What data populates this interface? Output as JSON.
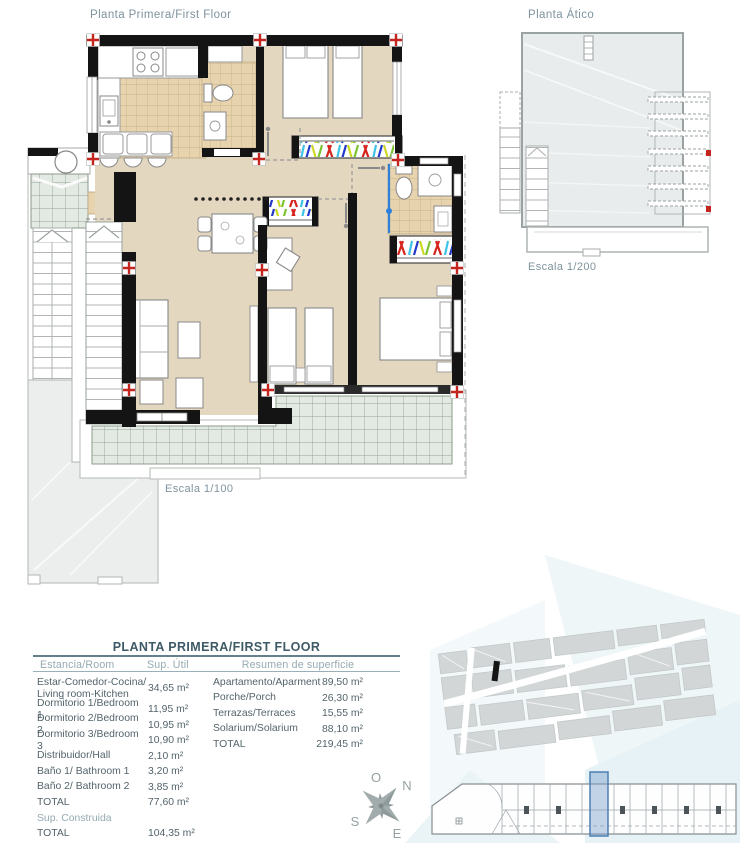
{
  "titles": {
    "first_floor": "Planta Primera/First Floor",
    "atico": "Planta Ático",
    "scale_main": "Escala 1/100",
    "scale_atico": "Escala 1/200"
  },
  "table": {
    "title": "PLANTA PRIMERA/FIRST FLOOR",
    "headers": {
      "room": "Estancia/Room",
      "area": "Sup. Útil",
      "summary": "Resumen de superficie"
    },
    "rooms": [
      {
        "label": "Estar-Comedor-Cocina/ Living room-Kitchen",
        "value": "34,65 m²"
      },
      {
        "label": "Dormitorio 1/Bedroom 1",
        "value": "11,95 m²"
      },
      {
        "label": "Dormitorio 2/Bedroom 2",
        "value": "10,95 m²"
      },
      {
        "label": "Dormitorio 3/Bedroom 3",
        "value": "10,90 m²"
      },
      {
        "label": "Distribuidor/Hall",
        "value": "2,10 m²"
      },
      {
        "label": "Baño 1/ Bathroom 1",
        "value": "3,20 m²"
      },
      {
        "label": "Baño 2/ Bathroom 2",
        "value": "3,85 m²"
      }
    ],
    "useful_total": {
      "label": "TOTAL",
      "value": "77,60 m²"
    },
    "built_header": "Sup. Construida",
    "built_total": {
      "label": "TOTAL",
      "value": "104,35 m²"
    },
    "summary_rows": [
      {
        "label": "Apartamento/Aparment",
        "value": "89,50 m²"
      },
      {
        "label": "Porche/Porch",
        "value": "26,30 m²"
      },
      {
        "label": "Terrazas/Terraces",
        "value": "15,55 m²"
      },
      {
        "label": "Solarium/Solarium",
        "value": "88,10 m²"
      },
      {
        "label": "TOTAL",
        "value": "219,45 m²"
      }
    ]
  },
  "compass": {
    "o": "O",
    "n": "N",
    "s": "S",
    "e": "E"
  },
  "colors": {
    "wall": "#141414",
    "cross_red": "#c4251f",
    "door_blue": "#2e7fd9",
    "floor_beige": "#e4d7c0",
    "tile_tan": "#e7d3ae",
    "tile_green": "#e3eae4",
    "unit_highlight": "#4d7fb5",
    "title_text": "#7e939d",
    "table_title": "#3d5a66",
    "table_header": "#95aab2",
    "table_body": "#53646b",
    "clothes_palette": [
      "#d6251d",
      "#3ec3e8",
      "#2238c8",
      "#ccd824",
      "#7bc32e"
    ]
  }
}
